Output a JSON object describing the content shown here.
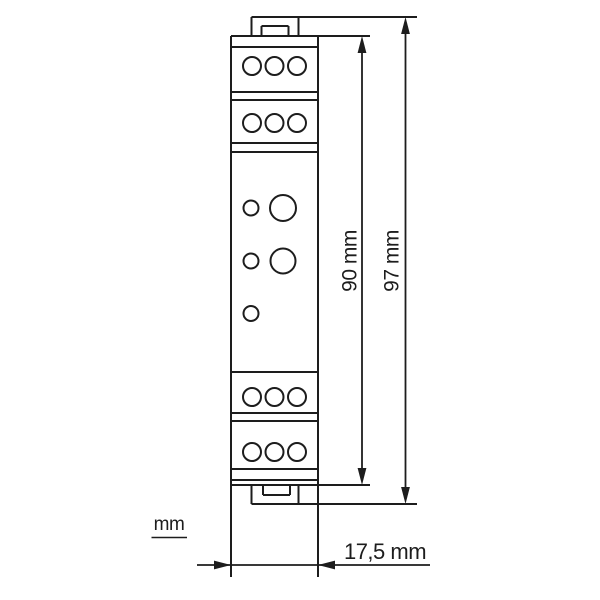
{
  "diagram": {
    "kind": "technical-dimension-drawing",
    "subject": "DIN-rail mounted module, side profile with screw terminal blocks",
    "labels": {
      "dim_inner_height": "90 mm",
      "dim_outer_height": "97 mm",
      "dim_width": "17,5 mm",
      "units_note": "mm"
    },
    "values": {
      "inner_height_mm": 90,
      "outer_height_mm": 97,
      "width_mm": 17.5
    },
    "structure": {
      "terminal_rows_top": 2,
      "terminal_rows_bottom": 2,
      "terminals_per_row": 3,
      "front_small_holes": 3,
      "front_large_holes": 2
    },
    "colors": {
      "line": "#1d1d1d",
      "background": "#ffffff"
    }
  }
}
